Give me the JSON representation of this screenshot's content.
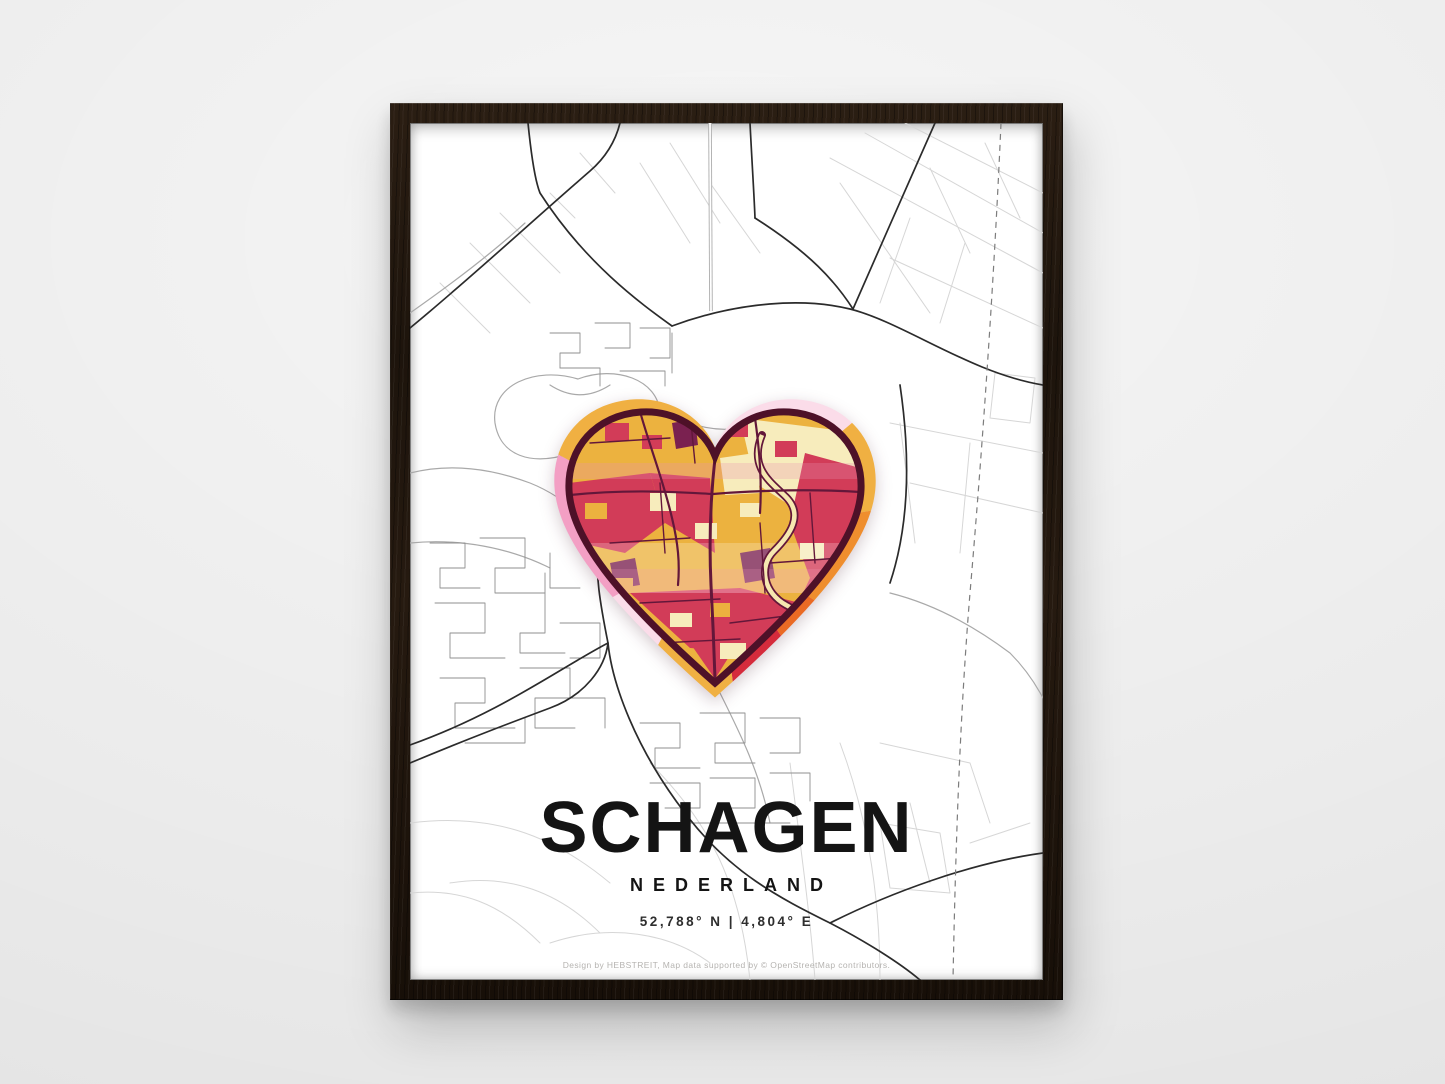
{
  "poster": {
    "title": "SCHAGEN",
    "subtitle": "NEDERLAND",
    "coordinates": "52,788° N | 4,804° E",
    "credit": "Design by HEBSTREIT, Map data supported by © OpenStreetMap contributors."
  },
  "theme": {
    "wall": "#ececec",
    "frame-wood": "#231812",
    "poster-bg": "#ffffff",
    "ink": "#141414",
    "road-dark": "#2b2b2b",
    "road-mid": "#a9a9a9",
    "road-faint": "#d6d6d6",
    "heart-border": "#4e1128",
    "heart-road": "#63173a",
    "heart-gold": "#ecb23f",
    "heart-cream": "#f7ecbc",
    "heart-crimson": "#d23c58",
    "heart-plum": "#7a2150",
    "halo-pink": "#f39fc4",
    "halo-pink-light": "#fbdce9",
    "halo-gold": "#f0b042",
    "halo-orange": "#ef8e2e",
    "halo-orange-deep": "#ea6a24",
    "halo-red": "#d52b3c"
  }
}
